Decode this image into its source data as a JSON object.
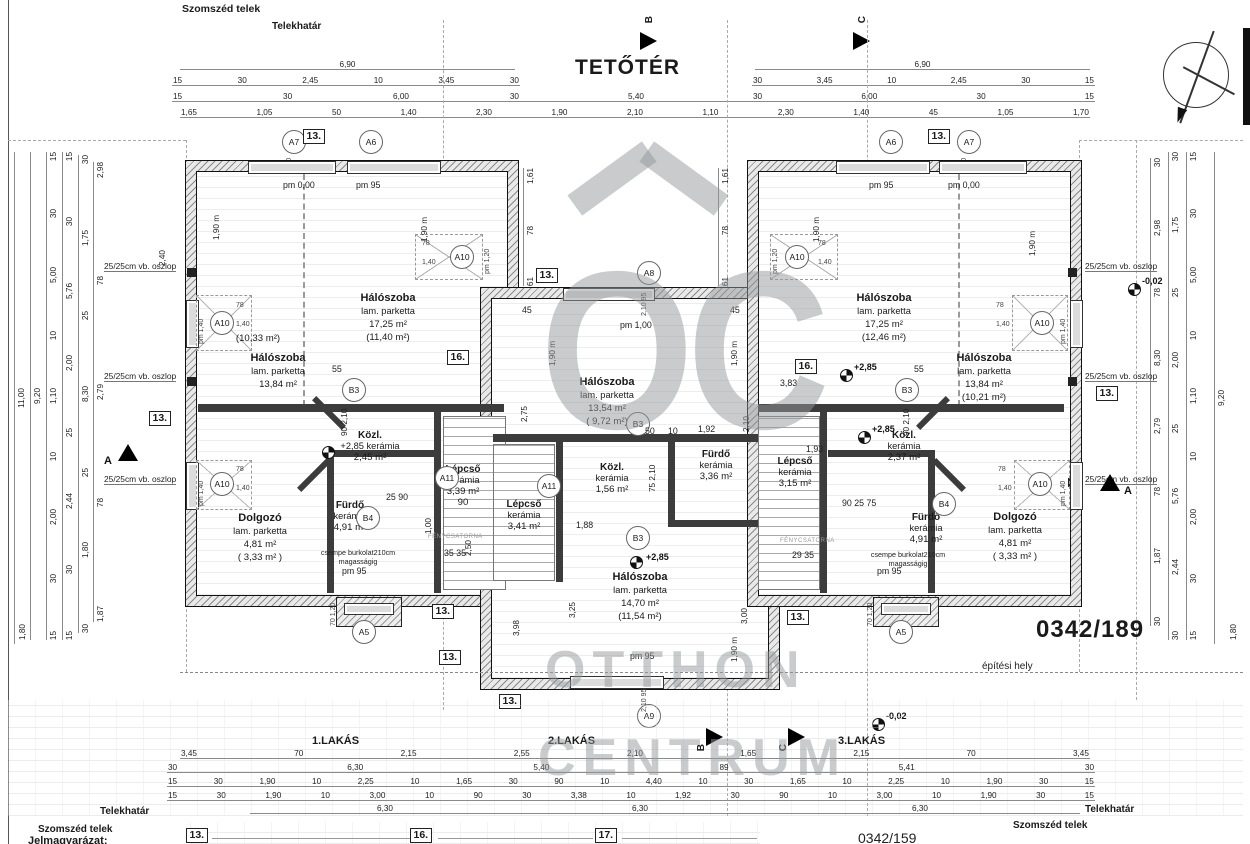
{
  "title": "TETŐTÉR",
  "site": {
    "szomszed_telek": "Szomszéd telek",
    "telekhatar": "Telekhatár",
    "plot_main": "0342/189",
    "plot_lower": "0342/159",
    "epitesi_hely": "építési hely",
    "jelmagyarazat": "Jelmagyarázat:"
  },
  "apartments": {
    "a1": "1.LAKÁS",
    "a2": "2.LAKÁS",
    "a3": "3.LAKÁS"
  },
  "markers": {
    "a5": "A5",
    "a6": "A6",
    "a7": "A7",
    "a8": "A8",
    "a9": "A9",
    "a10": "A10",
    "a11": "A11",
    "b3": "B3",
    "b4": "B4",
    "m13": "13.",
    "m16": "16.",
    "m17": "17.",
    "secA": "A",
    "secB": "B",
    "secC": "C"
  },
  "levels": {
    "p285": "+2,85",
    "m002": "-0,02",
    "pm000": "pm 0,00",
    "pm95": "pm 95",
    "pm100": "pm 1,00",
    "pm140": "pm 1,40",
    "pm120": "pm 1,20",
    "h190": "1,90 m"
  },
  "notes": {
    "oszlop": "25/25cm vb. oszlop",
    "csempe": [
      "csempe burkolat",
      "210cm magasságig"
    ],
    "feny": "FÉNYCSATORNA"
  },
  "rooms": {
    "l_halo1": {
      "name": "Hálószoba",
      "finish": "lam. parketta",
      "area": "13,84 m²"
    },
    "l_halo1_extra": "(10,33 m²)",
    "l_halo2": {
      "name": "Hálószoba",
      "finish": "lam. parketta",
      "area": "17,25 m²",
      "area2": "(11,40 m²)"
    },
    "l_kozl": {
      "name": "Közl.",
      "finish": "+2,85 kerámia",
      "area": "2,45 m²"
    },
    "l_lepcso": {
      "name": "Lépcső",
      "finish": "kerámia",
      "area": "3,39 m²",
      "extra": "90"
    },
    "l_furdo": {
      "name": "Fürdő",
      "finish": "kerámia",
      "area": "4,91 m²"
    },
    "l_dolgozo": {
      "name": "Dolgozó",
      "finish": "lam. parketta",
      "area": "4,81 m²",
      "area2": "( 3,33 m² )"
    },
    "c_halo1": {
      "name": "Hálószoba",
      "finish": "lam. parketta",
      "area": "13,54 m²",
      "area2": "( 9,72 m²)"
    },
    "c_kozl": {
      "name": "Közl.",
      "finish": "kerámia",
      "area": "1,56 m²"
    },
    "c_furdo": {
      "name": "Fürdő",
      "finish": "kerámia",
      "area": "3,36 m²"
    },
    "c_lepcso": {
      "name": "Lépcső",
      "finish": "kerámia",
      "area": "3,41 m²"
    },
    "c_halo2": {
      "name": "Hálószoba",
      "finish": "lam. parketta",
      "area": "14,70 m²",
      "area2": "(11,54 m²)"
    },
    "r_halo1": {
      "name": "Hálószoba",
      "finish": "lam. parketta",
      "area": "17,25 m²",
      "area2": "(12,46 m²)"
    },
    "r_halo2": {
      "name": "Hálószoba",
      "finish": "lam. parketta",
      "area": "13,84 m²",
      "area2": "(10,21 m²)"
    },
    "r_lepcso": {
      "name": "Lépcső",
      "finish": "kerámia",
      "area": "3,15 m²"
    },
    "r_kozl": {
      "name": "Közl.",
      "finish": "kerámia",
      "area": "2,37 m²"
    },
    "r_furdo": {
      "name": "Fürdő",
      "finish": "kerámia",
      "area": "4,91 m²"
    },
    "r_dolgozo": {
      "name": "Dolgozó",
      "finish": "lam. parketta",
      "area": "4,81 m²",
      "area2": "( 3,33 m² )"
    }
  },
  "dims": {
    "top1l": [
      "6,90"
    ],
    "top1r": [
      "6,90"
    ],
    "top2l": [
      "15",
      "30",
      "2,45",
      "10",
      "3,45",
      "30"
    ],
    "top2r": [
      "30",
      "3,45",
      "10",
      "2,45",
      "30",
      "15"
    ],
    "top3l": [
      "15",
      "30",
      "6,00",
      "30"
    ],
    "top3c": [
      "5,40"
    ],
    "top3r": [
      "30",
      "6,00",
      "30",
      "15"
    ],
    "top4": [
      "1,65",
      "1,05",
      "50",
      "1,40",
      "2,30",
      "1,90",
      "2,10",
      "1,10",
      "2,30",
      "1,40",
      "45",
      "1,05",
      "1,70"
    ],
    "bot1": [
      "3,45",
      "70",
      "2,15",
      "2,55",
      "2,10",
      "1,65",
      "2,15",
      "70",
      "3,45"
    ],
    "bot2": [
      "30",
      "6,30",
      "5,40",
      "89",
      "5,41",
      "30"
    ],
    "bot3": [
      "15",
      "30",
      "1,90",
      "10",
      "2,25",
      "10",
      "1,65",
      "30",
      "90",
      "10",
      "4,40",
      "10",
      "30",
      "1,65",
      "10",
      "2,25",
      "10",
      "1,90",
      "30",
      "15"
    ],
    "bot4": [
      "15",
      "30",
      "1,90",
      "10",
      "3,00",
      "10",
      "90",
      "30",
      "3,38",
      "10",
      "1,92",
      "30",
      "90",
      "10",
      "3,00",
      "10",
      "1,90",
      "30",
      "15"
    ],
    "bot5a": [
      "6,30"
    ],
    "bot5b": [
      "6,30"
    ],
    "bot5c": [
      "6,30"
    ],
    "left1": [
      "11,00"
    ],
    "left2": [
      "9,20"
    ],
    "left3": [
      "15",
      "30",
      "5,00",
      "10",
      "1,10",
      "10",
      "2,00",
      "30",
      "15"
    ],
    "left4": [
      "15",
      "30",
      "5,76",
      "2,00",
      "25",
      "2,44",
      "30",
      "15"
    ],
    "left5": [
      "30",
      "1,75",
      "25",
      "8,30",
      "25",
      "1,80",
      "30"
    ],
    "left6": [
      "2,98",
      "78",
      "2,79",
      "78",
      "1,87"
    ],
    "right1": [
      "30",
      "2,98",
      "78",
      "8,30",
      "2,79",
      "78",
      "1,87",
      "30"
    ],
    "right2": [
      "30",
      "1,75",
      "25",
      "2,00",
      "25",
      "5,76",
      "2,44",
      "30"
    ],
    "right3": [
      "15",
      "30",
      "5,00",
      "10",
      "1,10",
      "10",
      "2,00",
      "30",
      "15"
    ],
    "right4": [
      "9,20"
    ],
    "cy": [
      "1,61",
      "78",
      "61"
    ],
    "v180": "1,80"
  },
  "micro": {
    "m240": "2,40",
    "m55": "55",
    "m9021": "90  2,10",
    "m50": "50",
    "m10": "10",
    "m192": "1,92",
    "m7521": "75  2,10",
    "m188": "1,88",
    "m325": "3,25",
    "m398": "3,98",
    "m300": "3,00",
    "m250": "2,50",
    "m3535": "35  35",
    "m2935": "29  35",
    "m193": "1,93",
    "m383": "3,83",
    "m2590": "25  90",
    "m902575": "90  25  75",
    "m100": "1,00",
    "m275": "2,75",
    "m210": "2,10",
    "m7012": "70  1,20",
    "m21095": "2,10  95",
    "m10521": "1,05  2,10",
    "m14095": "1,40  95",
    "m7814": [
      "78",
      "1,40"
    ],
    "m45": "45"
  }
}
